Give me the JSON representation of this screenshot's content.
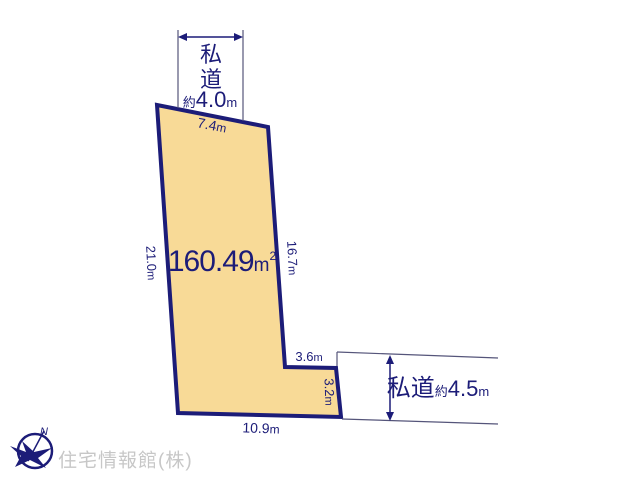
{
  "colors": {
    "plot_fill": "#F8DA97",
    "navy": "#1C1C78",
    "thin_line": "#55557A",
    "watermark_gray": "#C7C7C7"
  },
  "plot": {
    "area_value": "160.49",
    "area_unit": "m",
    "area_unit_exponent": "2"
  },
  "top_road": {
    "name_vertical": [
      "私",
      "道"
    ],
    "approx_prefix": "約",
    "width_value": "4.0",
    "width_unit": "m"
  },
  "side_road": {
    "name": "私道",
    "approx_prefix": "約",
    "width_value": "4.5",
    "width_unit": "m"
  },
  "dimensions": {
    "top": {
      "value": "7.4",
      "unit": "m"
    },
    "left": {
      "value": "21.0",
      "unit": "m"
    },
    "right": {
      "value": "16.7",
      "unit": "m"
    },
    "step_top": {
      "value": "3.6",
      "unit": "m"
    },
    "step_side": {
      "value": "3.2",
      "unit": "m"
    },
    "bottom": {
      "value": "10.9",
      "unit": "m"
    }
  },
  "compass": {
    "north": "N"
  },
  "watermark": {
    "text": "住宅情報館(株)"
  }
}
